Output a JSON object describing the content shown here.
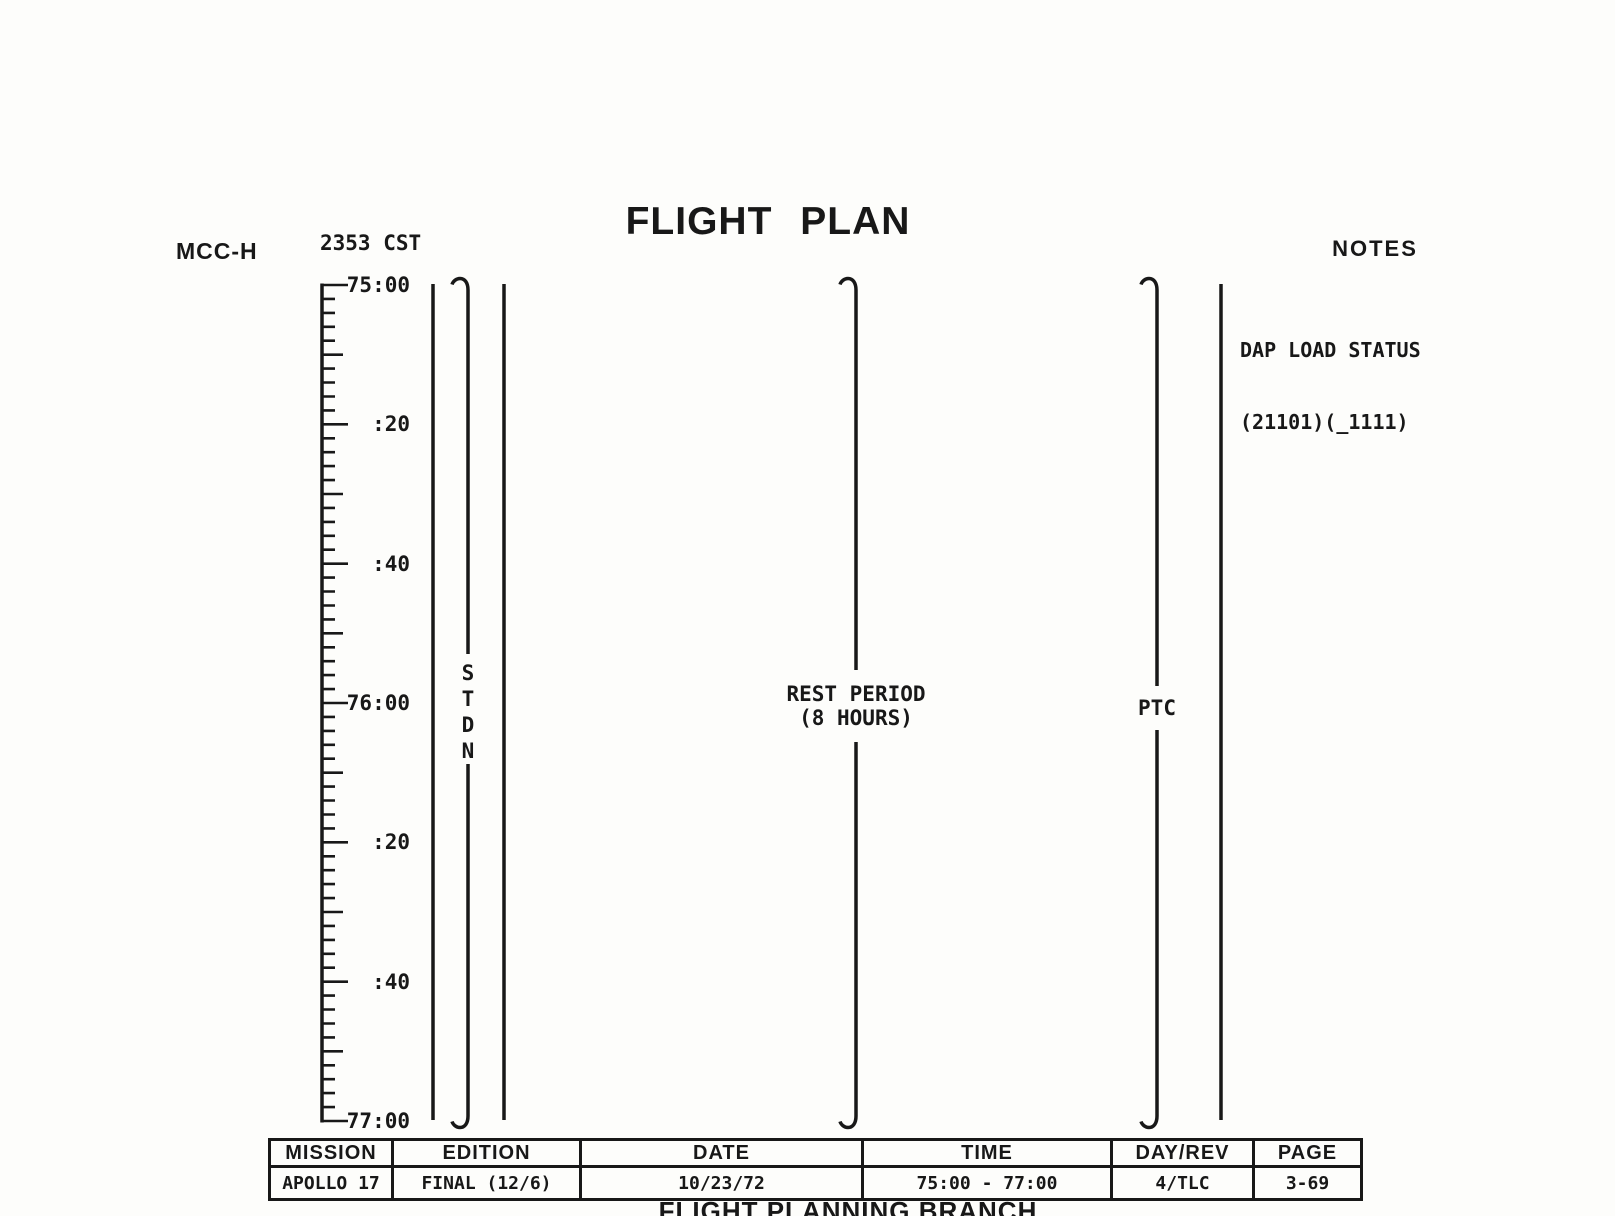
{
  "colors": {
    "ink": "#181818",
    "paper": "#fdfdfb"
  },
  "header": {
    "station": "MCC-H",
    "clock": "2353 CST",
    "title": "FLIGHT PLAN",
    "notes_heading": "NOTES"
  },
  "notes": [
    "DAP LOAD STATUS",
    "(21101)(_1111)"
  ],
  "timeline": {
    "axis_title": "GET",
    "start": "75:00",
    "end": "77:00",
    "minor_tick_minutes": 2,
    "medium_tick_minutes": 10,
    "labeled_tick_minutes": 20,
    "tick_labels": [
      {
        "minutes": 0,
        "label": "75:00"
      },
      {
        "minutes": 20,
        "label": ":20"
      },
      {
        "minutes": 40,
        "label": ":40"
      },
      {
        "minutes": 60,
        "label": "76:00"
      },
      {
        "minutes": 80,
        "label": ":20"
      },
      {
        "minutes": 100,
        "label": ":40"
      },
      {
        "minutes": 120,
        "label": "77:00"
      }
    ],
    "events": [
      {
        "id": "stdn",
        "label": "STDN",
        "orientation": "stacked-vertical",
        "span": [
          "75:00",
          "77:00"
        ]
      },
      {
        "id": "rest-period",
        "label_lines": [
          "REST PERIOD",
          "(8 HOURS)"
        ],
        "span": [
          "75:00",
          "77:00"
        ]
      },
      {
        "id": "ptc",
        "label": "PTC",
        "span": [
          "75:00",
          "77:00"
        ]
      }
    ]
  },
  "footer_table": {
    "columns": [
      {
        "header": "MISSION",
        "value": "APOLLO 17"
      },
      {
        "header": "EDITION",
        "value": "FINAL (12/6)"
      },
      {
        "header": "DATE",
        "value": "10/23/72"
      },
      {
        "header": "TIME",
        "value": "75:00 - 77:00"
      },
      {
        "header": "DAY/REV",
        "value": "4/TLC"
      },
      {
        "header": "PAGE",
        "value": "3-69"
      }
    ]
  },
  "footer_branch": "FLIGHT PLANNING BRANCH"
}
